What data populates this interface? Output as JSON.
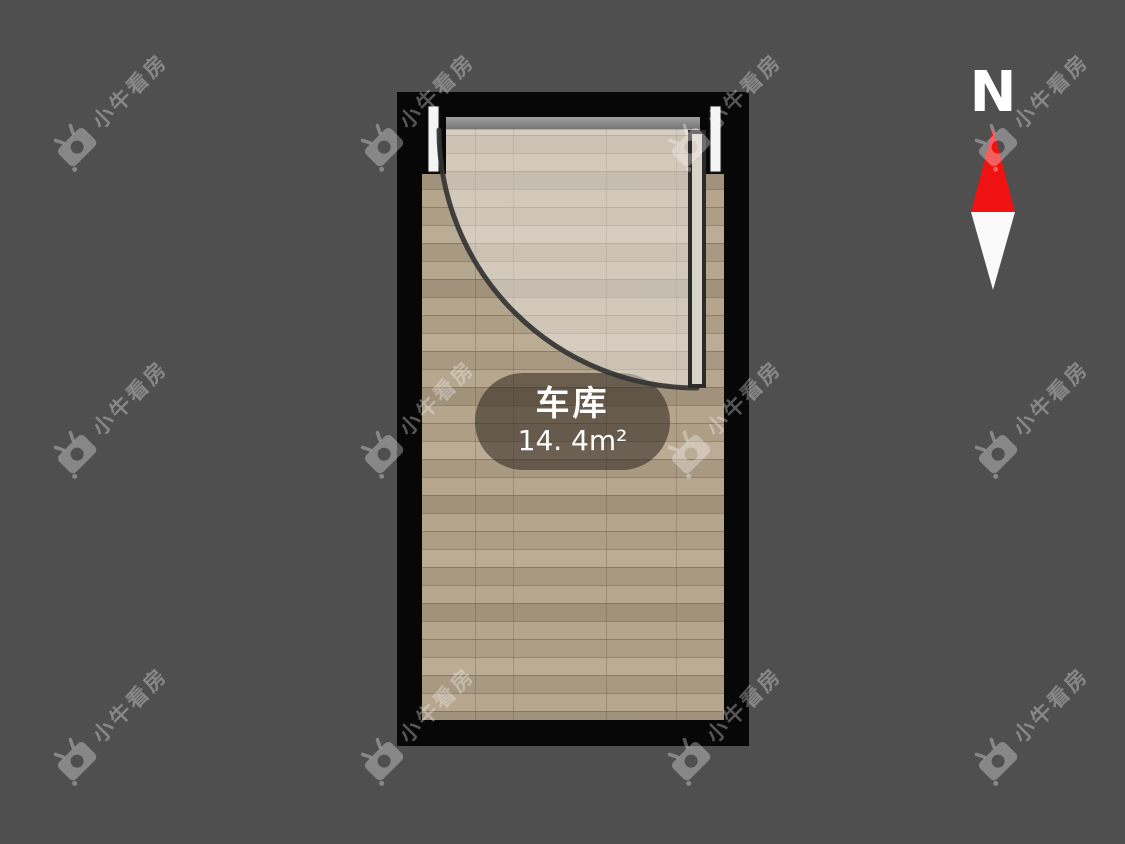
{
  "watermark": {
    "text": "小牛看房",
    "icon": "niu-logo-icon"
  },
  "floor_plan": {
    "room": {
      "name": "车库",
      "area": "14. 4m²"
    }
  },
  "compass": {
    "label": "N"
  },
  "colors": {
    "background": "#4f4f4f",
    "wall": "#070707",
    "wood": "#b3a38a",
    "door_swing_highlight": "rgba(255,255,255,0.40)",
    "door_threshold_gray": "#8e8e8e",
    "compass_red": "#ee1212",
    "label_pill": "rgba(45,37,29,0.56)"
  }
}
